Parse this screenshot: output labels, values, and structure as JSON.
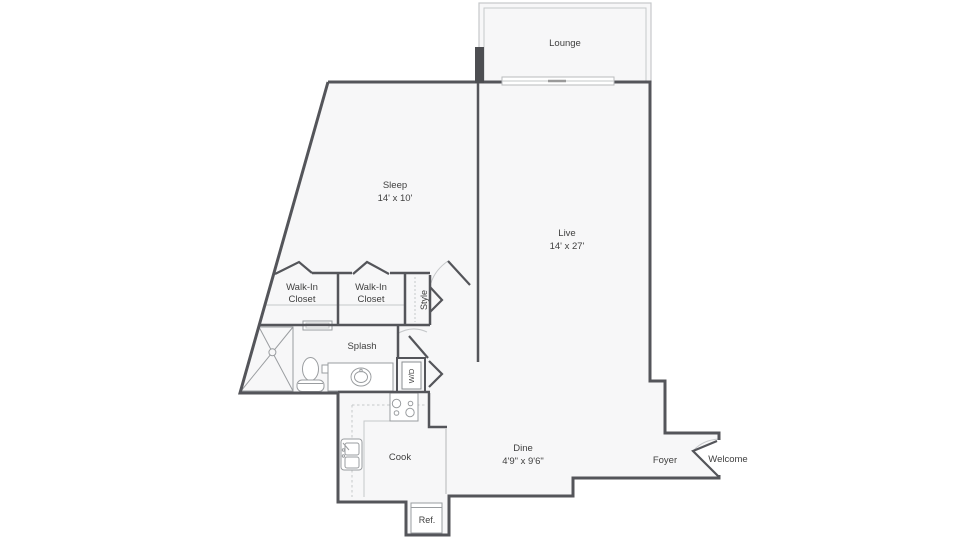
{
  "plan": {
    "title": "One bedroom apartment floor plan",
    "rooms": {
      "lounge": {
        "label": "Lounge"
      },
      "sleep": {
        "label": "Sleep",
        "dims": "14' x 10'"
      },
      "live": {
        "label": "Live",
        "dims": "14' x 27'"
      },
      "closet1": {
        "line1": "Walk-In",
        "line2": "Closet"
      },
      "closet2": {
        "line1": "Walk-In",
        "line2": "Closet"
      },
      "style": {
        "label": "Style"
      },
      "splash": {
        "label": "Splash"
      },
      "cook": {
        "label": "Cook"
      },
      "dine": {
        "label": "Dine",
        "dims": "4'9\" x 9'6\""
      },
      "foyer": {
        "label": "Foyer"
      },
      "welcome": {
        "label": "Welcome"
      },
      "ref": {
        "label": "Ref."
      },
      "washer_dryer": {
        "label": "W/D"
      }
    },
    "colors": {
      "wall": "#54555a",
      "floor": "#f7f7f8",
      "fixture": "#9a9da0",
      "light_line": "#c6c8ca",
      "text": "#3f3f3f"
    }
  }
}
